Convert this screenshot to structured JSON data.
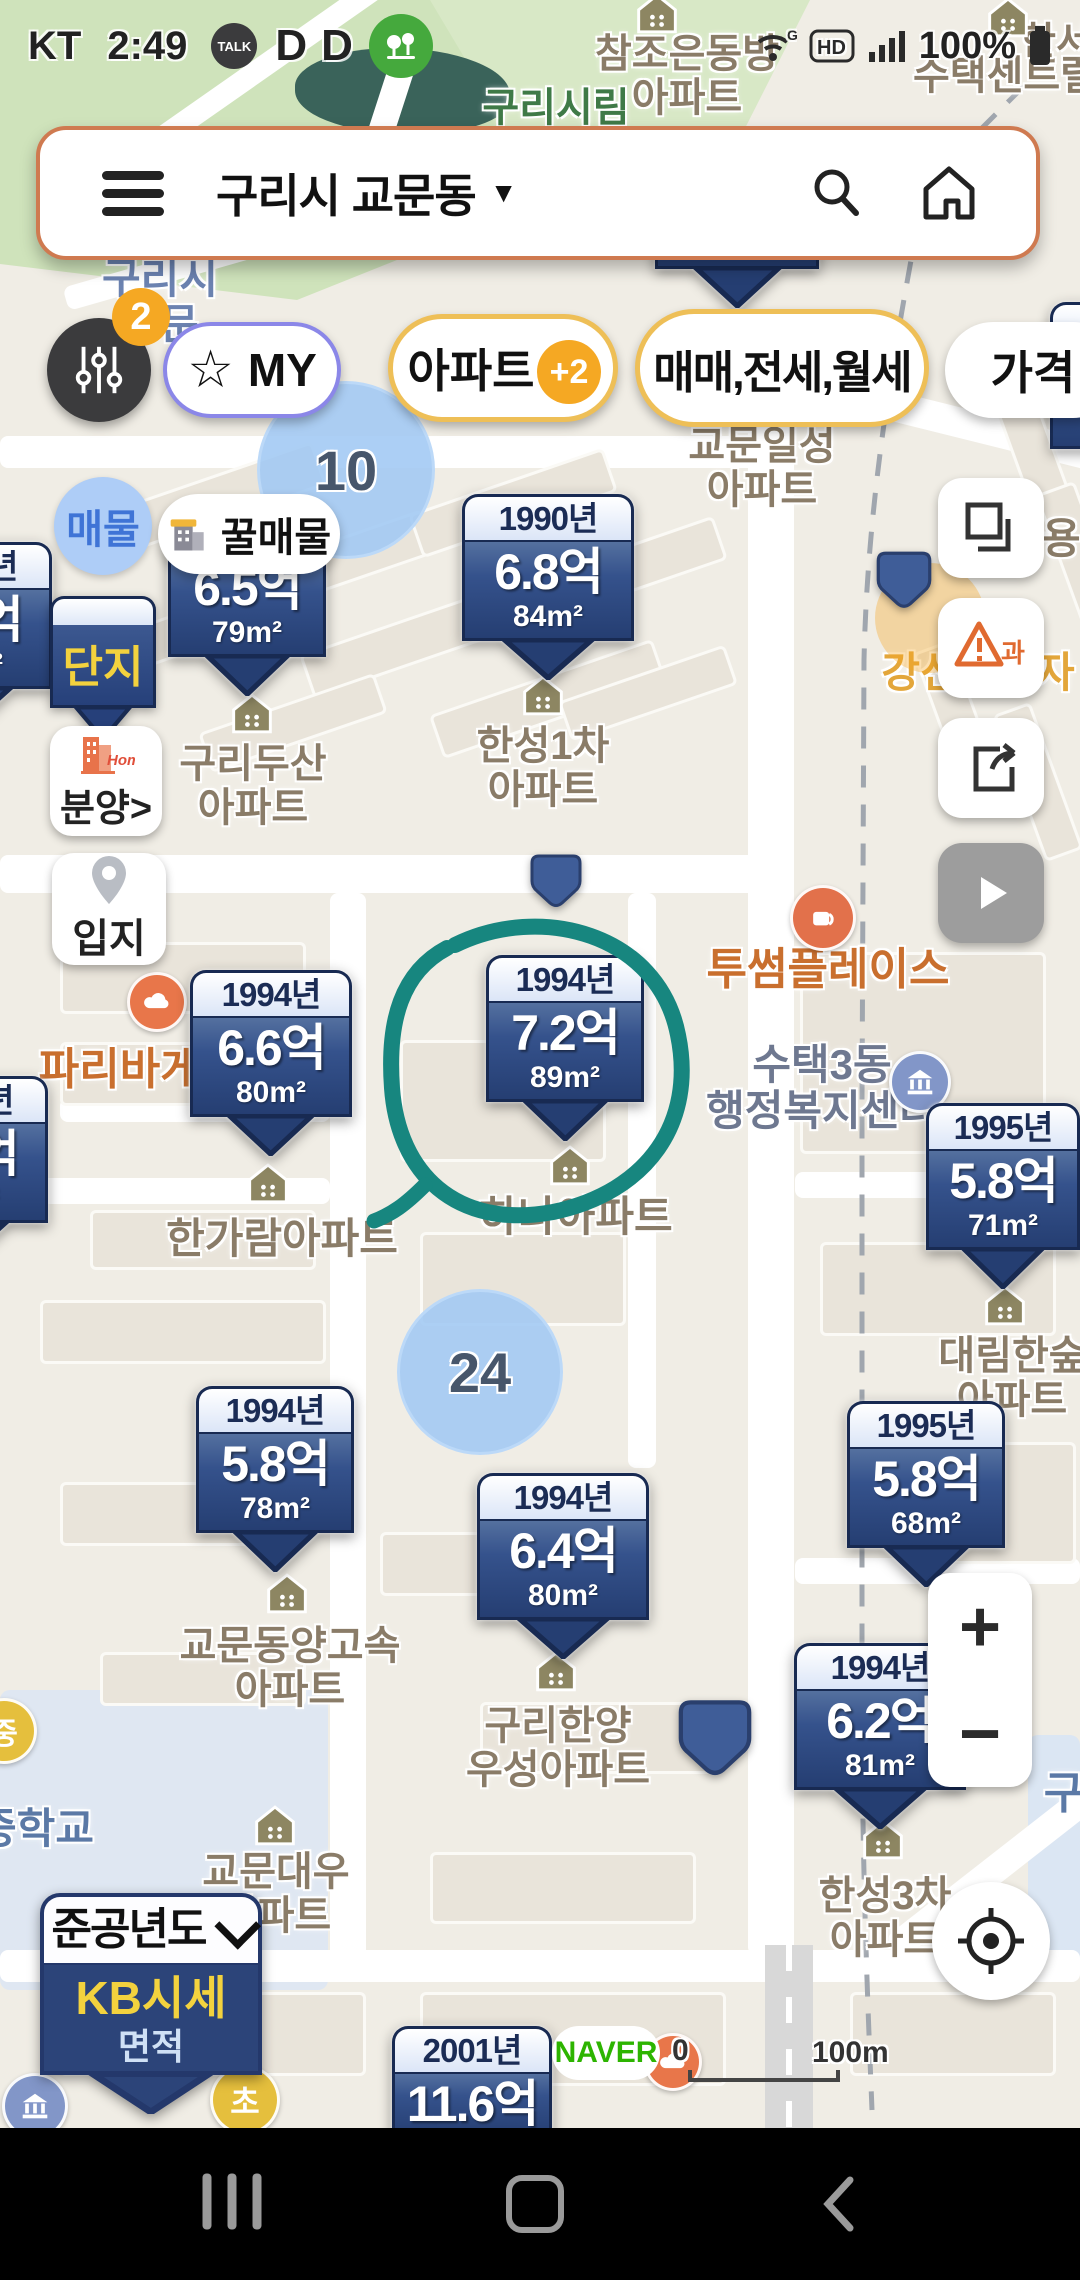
{
  "status_bar": {
    "carrier": "KT",
    "time": "2:49",
    "kakao_label": "TALK",
    "app_letter": "D",
    "battery_pct": "100%"
  },
  "search_bar": {
    "location": "구리시 교문동",
    "caret": "▼"
  },
  "filter_bar": {
    "badge": "2",
    "star": "☆",
    "my_label": "MY",
    "apt_label": "아파트",
    "apt_badge": "+2",
    "deal_label": "매매,전세,월세",
    "price_label": "가격"
  },
  "side_buttons": {
    "listing": "매물",
    "honey": "꿀매물",
    "complex": "단지",
    "presale_home": "Home",
    "presale": "분양>",
    "location": "입지"
  },
  "zoom_controls": {
    "zoom_in": "+",
    "zoom_out": "−"
  },
  "legend_marker": {
    "title": "준공년도",
    "primary": "KB시세",
    "secondary": "면적"
  },
  "footer": {
    "brand": "NAVER",
    "scale_start": "0",
    "scale_end": "100m",
    "poi": "파리바게뜨"
  },
  "clusters": [
    {
      "label": "10",
      "x": 346,
      "y": 470,
      "r": 86
    },
    {
      "label": "24",
      "x": 480,
      "y": 1372,
      "r": 80
    }
  ],
  "markers": [
    {
      "year": "",
      "price": "6.2억",
      "area": "108m²",
      "x": 655,
      "y": 165,
      "w": 164
    },
    {
      "year": "1990년",
      "price": "6.3억",
      "area": "103m²",
      "x": 1050,
      "y": 302,
      "w": 180
    },
    {
      "year": "1991년",
      "price": "6.5억",
      "area": "79m²",
      "x": 168,
      "y": 510,
      "w": 158
    },
    {
      "year": "1990년",
      "price": "6.8억",
      "area": "84m²",
      "x": 462,
      "y": 494,
      "w": 172
    },
    {
      "year": "1991년",
      "price": "6.1억",
      "area": "78m²",
      "x": -116,
      "y": 542,
      "w": 168
    },
    {
      "year": "1994년",
      "price": "6.6억",
      "area": "80m²",
      "x": 190,
      "y": 970,
      "w": 162
    },
    {
      "year": "1994년",
      "price": "7.2억",
      "area": "89m²",
      "x": 486,
      "y": 955,
      "w": 158
    },
    {
      "year": "1995년",
      "price": "5.8억",
      "area": "71m²",
      "x": 926,
      "y": 1103,
      "w": 154
    },
    {
      "year": "1994년",
      "price": "5.9억",
      "area": "80m²",
      "x": -120,
      "y": 1076,
      "w": 168
    },
    {
      "year": "1994년",
      "price": "5.8억",
      "area": "78m²",
      "x": 196,
      "y": 1386,
      "w": 158
    },
    {
      "year": "1994년",
      "price": "6.4억",
      "area": "80m²",
      "x": 477,
      "y": 1473,
      "w": 172
    },
    {
      "year": "1995년",
      "price": "5.8억",
      "area": "68m²",
      "x": 847,
      "y": 1401,
      "w": 158
    },
    {
      "year": "1994년",
      "price": "6.2억",
      "area": "81m²",
      "x": 794,
      "y": 1643,
      "w": 172
    },
    {
      "year": "2001년",
      "price": "11.6억",
      "area": "",
      "x": 392,
      "y": 2026,
      "w": 160
    }
  ],
  "dot_markers": [
    {
      "x": 530,
      "y": 853,
      "s": 52
    },
    {
      "x": 876,
      "y": 550,
      "s": 56
    },
    {
      "x": 678,
      "y": 1698,
      "s": 74
    }
  ],
  "map_labels": [
    {
      "lines": [
        "구리시림"
      ],
      "x": 556,
      "y": 86,
      "color": "#3f7a47",
      "size": 40
    },
    {
      "lines": [
        "참조은동방",
        "아파트"
      ],
      "x": 687,
      "y": 32,
      "size": 40
    },
    {
      "lines": [
        "수택센트럴"
      ],
      "x": 1005,
      "y": 54,
      "size": 40
    },
    {
      "lines": [
        "한서"
      ],
      "x": 1056,
      "y": 22,
      "size": 38
    },
    {
      "lines": [
        "구리시",
        "교문"
      ],
      "x": 160,
      "y": 256,
      "color": "#6b82b0",
      "size": 42
    },
    {
      "lines": [
        "교문일성",
        "아파트"
      ],
      "x": 762,
      "y": 424,
      "size": 40
    },
    {
      "lines": [
        "쌍용"
      ],
      "x": 1042,
      "y": 516,
      "size": 42
    },
    {
      "lines": [
        "강신프라자"
      ],
      "x": 978,
      "y": 650,
      "color": "#e3a63a",
      "size": 42
    },
    {
      "lines": [
        "투썸플레이스"
      ],
      "x": 828,
      "y": 946,
      "color": "#c96f2e",
      "size": 44
    },
    {
      "lines": [
        "수택3동",
        "행정복지센터"
      ],
      "x": 822,
      "y": 1042,
      "color": "#6e7890",
      "size": 42
    },
    {
      "lines": [
        "파리바게뜨"
      ],
      "x": 140,
      "y": 1046,
      "color": "#c96f2e",
      "size": 44
    },
    {
      "lines": [
        "한가람아파트"
      ],
      "x": 282,
      "y": 1216,
      "size": 42
    },
    {
      "lines": [
        "하나아파트"
      ],
      "x": 576,
      "y": 1194,
      "size": 42
    },
    {
      "lines": [
        "한성1차",
        "아파트"
      ],
      "x": 543,
      "y": 724,
      "size": 40
    },
    {
      "lines": [
        "구리두산",
        "아파트"
      ],
      "x": 253,
      "y": 742,
      "size": 40
    },
    {
      "lines": [
        "대림한숲",
        "아파트"
      ],
      "x": 1012,
      "y": 1334,
      "size": 40
    },
    {
      "lines": [
        "교문동양고속",
        "아파트"
      ],
      "x": 290,
      "y": 1624,
      "size": 40
    },
    {
      "lines": [
        "구리한양",
        "우성아파트"
      ],
      "x": 558,
      "y": 1704,
      "size": 40
    },
    {
      "lines": [
        "교문대우",
        "아파트"
      ],
      "x": 276,
      "y": 1850,
      "size": 40
    },
    {
      "lines": [
        "한성3차",
        "아파트"
      ],
      "x": 885,
      "y": 1874,
      "size": 40
    },
    {
      "lines": [
        "중학교"
      ],
      "x": 36,
      "y": 1806,
      "color": "#5b79a6",
      "size": 42
    },
    {
      "lines": [
        "구"
      ],
      "x": 1064,
      "y": 1770,
      "color": "#5b79a6",
      "size": 44
    }
  ],
  "poi_icons": [
    {
      "type": "warnbg",
      "label": "",
      "x": 930,
      "y": 618,
      "r": 55
    },
    {
      "type": "coffee",
      "label": "",
      "x": 823,
      "y": 918,
      "r": 30
    },
    {
      "type": "bank",
      "label": "",
      "x": 920,
      "y": 1082,
      "r": 28
    },
    {
      "type": "cloud",
      "label": "",
      "x": 157,
      "y": 1002,
      "r": 27
    },
    {
      "type": "cloud",
      "label": "",
      "x": 673,
      "y": 2062,
      "r": 26
    },
    {
      "type": "school",
      "label": "초",
      "x": 245,
      "y": 2100,
      "r": 32
    },
    {
      "type": "school",
      "label": "중",
      "x": 4,
      "y": 1731,
      "r": 30
    },
    {
      "type": "bank",
      "label": "",
      "x": 35,
      "y": 2106,
      "r": 30
    }
  ],
  "house_icons": [
    [
      543,
      698
    ],
    [
      252,
      716
    ],
    [
      268,
      1186
    ],
    [
      570,
      1168
    ],
    [
      1005,
      1308
    ],
    [
      287,
      1596
    ],
    [
      556,
      1674
    ],
    [
      883,
      1842
    ],
    [
      275,
      1828
    ],
    [
      657,
      16
    ],
    [
      1008,
      20
    ]
  ]
}
